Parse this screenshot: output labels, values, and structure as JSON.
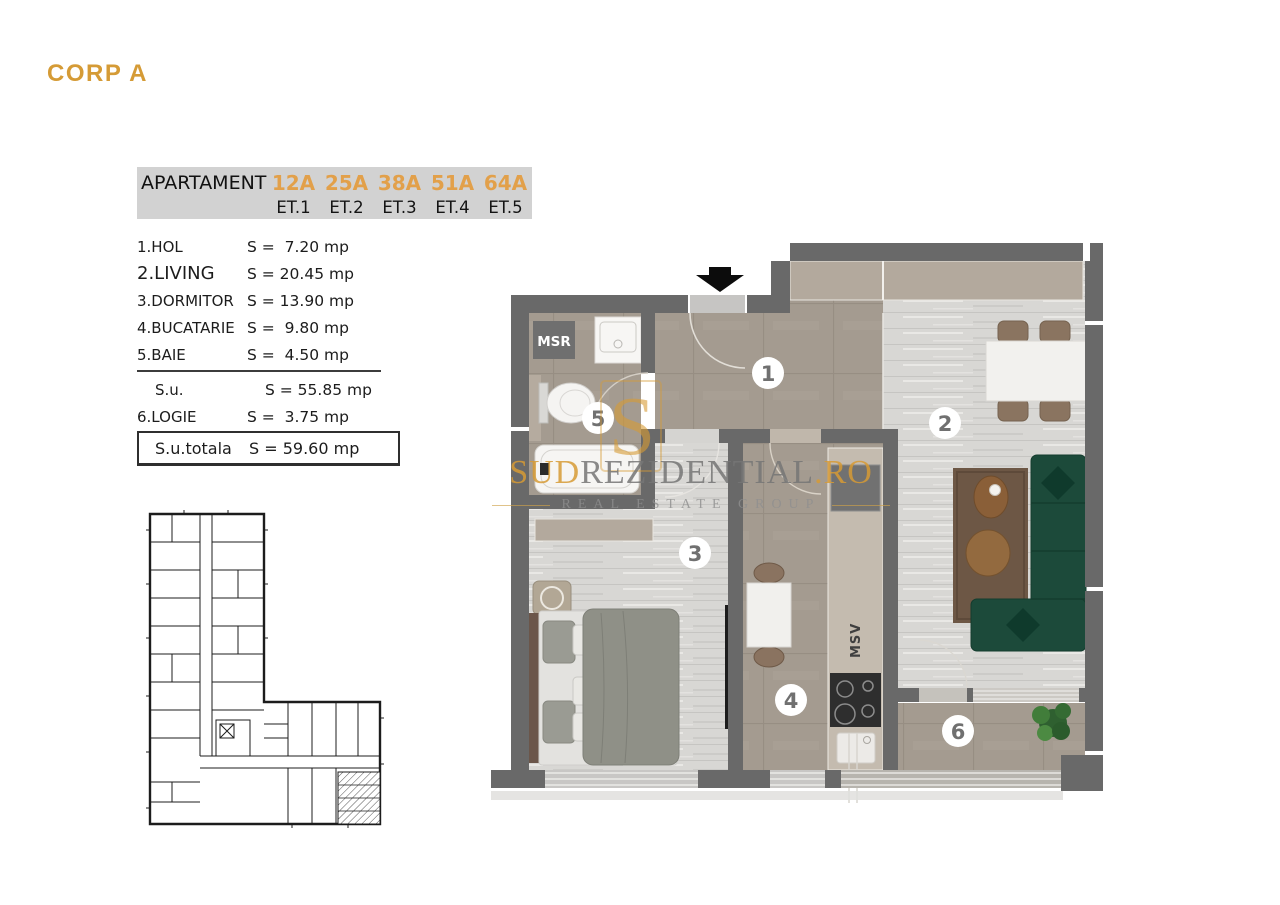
{
  "sheet": {
    "title": "CORP A"
  },
  "apartment_table": {
    "label": "APARTAMENT",
    "units": [
      "12A",
      "25A",
      "38A",
      "51A",
      "64A"
    ],
    "floors": [
      "ET.1",
      "ET.2",
      "ET.3",
      "ET.4",
      "ET.5"
    ]
  },
  "rooms": [
    {
      "name": "1.HOL",
      "area": "S =  7.20 mp"
    },
    {
      "name": "2.LIVING",
      "area": "S = 20.45 mp"
    },
    {
      "name": "3.DORMITOR",
      "area": "S = 13.90 mp"
    },
    {
      "name": "4.BUCATARIE",
      "area": "S =  9.80 mp"
    },
    {
      "name": "5.BAIE",
      "area": "S =  4.50 mp"
    }
  ],
  "summary": {
    "usable": {
      "name": "S.u.",
      "area": "S = 55.85 mp"
    },
    "loggia": {
      "name": "6.LOGIE",
      "area": "S =  3.75 mp"
    },
    "total": {
      "name": "S.u.totala",
      "area": "S = 59.60 mp"
    }
  },
  "plan": {
    "numbers": [
      "1",
      "2",
      "3",
      "4",
      "5",
      "6"
    ],
    "msr": "MSR",
    "msv": "MSV"
  },
  "watermark": {
    "brand_gold_prefix": "SUD",
    "brand_gray": "REZIDENTIAL",
    "brand_gold_suffix": ".RO",
    "tagline": "REAL ESTATE GROUP",
    "monogram": "S"
  },
  "colors": {
    "accent_orange": "#e2a04a",
    "title_gold": "#d59b36",
    "table_bg": "#d2d2d2",
    "wall_gray": "#696969",
    "tile_floor": "#a49b90",
    "wood_floor": "#d8d7d4",
    "sofa_green": "#1c4a3a",
    "rug_brown": "#6d5745",
    "watermark_gold": "#d79b35"
  }
}
